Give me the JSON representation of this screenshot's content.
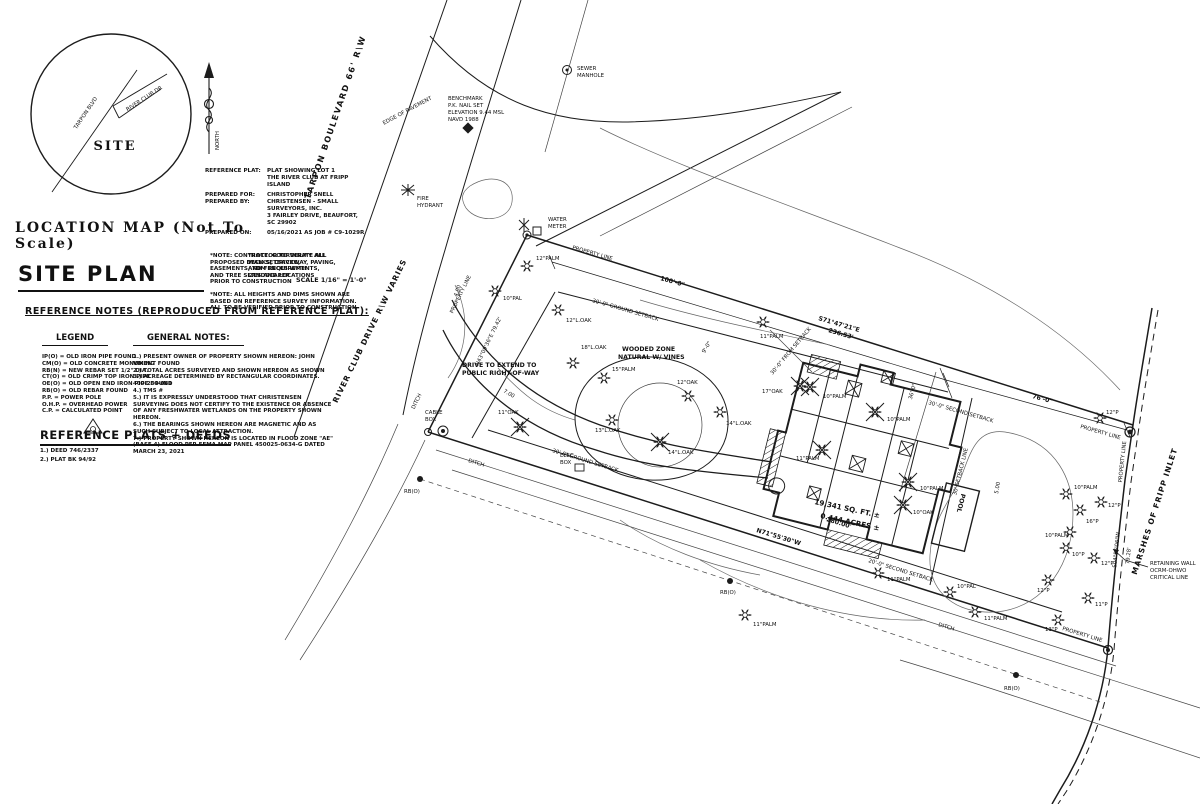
{
  "location_map": {
    "caption": "LOCATION MAP  (Not To Scale)",
    "road_tarpon": "TARPON BLVD",
    "road_river_club": "RIVER CLUB DR",
    "site": "SITE",
    "north": "NORTH"
  },
  "title_block": {
    "rows": [
      {
        "label": "REFERENCE PLAT:",
        "value": "PLAT SHOWING LOT 1"
      },
      {
        "label": "",
        "value": "THE RIVER CLUB AT FRIPP ISLAND"
      },
      {
        "label": "PREPARED FOR:",
        "value": "CHRISTOPHER SNELL"
      },
      {
        "label": "PREPARED BY:",
        "value": "CHRISTENSEN - SMALL SURVEYORS, INC."
      },
      {
        "label": "",
        "value": "3 FAIRLEY DRIVE, BEAUFORT, SC 29902"
      },
      {
        "label": "PREPARED ON:",
        "value": "05/16/2021 AS JOB # C9-1029R"
      }
    ]
  },
  "header": {
    "title": "SITE PLAN",
    "note_a": "*NOTE: CONTRACTOR TO VERIFY ALL PROPOSED DECK SETBACKS, EASEMENTS, TDM REQUIREMENTS, AND TREE SIZES AND LOCATIONS PRIOR TO CONSTRUCTION",
    "note_b": "*NOTE: COORDINATE ALL WALKS, DRIVEWAY, PAVING, AND FENCES WITH LANDSCAPER",
    "note_c": "*NOTE: ALL HEIGHTS AND DIMS SHOWN ARE BASED ON REFERENCE SURVEY INFORMATION. ALL TO BE VERIFIED PRIOR TO CONSTRUCTION",
    "scale": "SCALE 1/16\" = 1'-0\""
  },
  "reference_notes": {
    "heading": "REFERENCE NOTES (REPRODUCED FROM REFERENCE PLAT):",
    "legend_heading": "LEGEND",
    "legend_items": [
      "IP(O) = OLD IRON PIPE FOUND",
      "CM(O) = OLD CONCRETE MONUMENT FOUND",
      "RB(N) = NEW REBAR SET 1/2\" DIA.",
      "CT(O) = OLD CRIMP TOP IRON PIPE",
      "OE(O) = OLD OPEN END IRON PIPE FOUND",
      "RB(O) = OLD REBAR FOUND",
      "P.P.  = POWER POLE",
      "O.H.P. = OVERHEAD POWER",
      "C.P.  = CALCULATED POINT"
    ],
    "notes_heading": "GENERAL NOTES:",
    "notes_items": [
      "1.) PRESENT OWNER OF PROPERTY SHOWN HEREON: JOHN VIKING",
      "2.) TOTAL ACRES SURVEYED AND SHOWN HEREON AS SHOWN",
      "3.) ACREAGE DETERMINED BY RECTANGULAR COORDINATES.  400-234-081",
      "4.) TMS #",
      "5.) IT IS EXPRESSLY UNDERSTOOD THAT CHRISTENSEN SURVEYING DOES NOT CERTIFY TO THE EXISTENCE OR ABSENCE OF ANY FRESHWATER WETLANDS ON THE PROPERTY SHOWN HEREON.",
      "6.) THE BEARINGS SHOWN HEREON ARE MAGNETIC AND AS SUCH SUBJECT TO LOCAL ATTRACTION.",
      "7.) PROPERTY SHOWN HEREON IS LOCATED IN FLOOD ZONE \"AE\" (BASE 4) FLOOD PER FEMA MAP PANEL 450025-0634-G DATED  MARCH 23, 2021"
    ]
  },
  "plats_deeds": {
    "heading": "REFERENCE PLATS + DEEDS",
    "items": [
      "1.) DEED 746/2337",
      "2.) PLAT BK 94/92"
    ]
  },
  "plan": {
    "road_tarpon": "TARPON BOULEVARD  66' R\\W",
    "edge_of_pavement": "EDGE OF PAVEMENT",
    "road_river_club": "RIVER CLUB DRIVE  R\\W VARIES",
    "sewer1": "SEWER",
    "sewer2": "MANHOLE",
    "bm1": "BENCHMARK",
    "bm2": "P.K. NAIL SET",
    "bm3": "ELEVATION 9.44 MSL",
    "bm4": "NAVD 1988",
    "fh1": "FIRE",
    "fh2": "HYDRANT",
    "wm1": "WATER",
    "wm2": "METER",
    "property_line": "PROPERTY LINE",
    "dim100": "100'-0\"",
    "dim76": "76'-0\"",
    "dim36": "36'-0\"",
    "dim9": "9'-0\"",
    "brg_n1": "S71°47'21\"E",
    "brg_n2": "236.53'",
    "brg_w": "N43°09'36\"E  79.42'",
    "brg_s1": "280.00'",
    "brg_s2": "N71°55'30\"W",
    "brg_e1": "S04°56'06\"W",
    "brg_e2": "79.28'",
    "ground_setback": "30'-0\" GROUND SETBACK",
    "second_setback": "30'-0\" SECOND SETBACK",
    "from_setback": "30'-0\" FROM SETBACK",
    "setback_line": "30' SETBACK LINE",
    "second_setback_s": "20'-0\" SECOND SETBACK",
    "drive1": "DRIVE TO EXTEND TO",
    "drive2": "PUBLIC RIGHT-OF-WAY",
    "wood1": "WOODED ZONE",
    "wood2": "NATURAL W/ VINES",
    "cable1": "CABLE",
    "cable2": "BOX",
    "elec1": "ELEC",
    "elec2": "BOX",
    "ditch": "DITCH",
    "rbo": "RB(O)",
    "area1": "19,341 SQ. FT. ±",
    "area2": "0.444 ACRES ±",
    "pool": "POOL",
    "marshes": "MARSHES OF FRIPP INLET",
    "ret1": "RETAINING WALL",
    "ret2": "OCRM-OHWO",
    "ret3": "CRITICAL LINE",
    "c4": "4.00",
    "c5": "5.00",
    "c7": "7.00",
    "tree_labels": [
      "12\"PALM",
      "10\"PAL",
      "12\"L.OAK",
      "18\"L.OAK",
      "15\"PALM",
      "12\"OAK",
      "17\"OAK",
      "14\"L.OAK",
      "14\"L.OAK",
      "13\"L.OAK",
      "11\"OAK",
      "11\"PALM",
      "10\"PALM",
      "10\"PALM",
      "11\"PALM",
      "10\"PALM",
      "10\"OAK",
      "11\"PALM",
      "11\"PALM",
      "10\"PAL",
      "11\"PALM",
      "10\"PALM",
      "16\"P",
      "12\"P",
      "10\"PALM",
      "10\"P",
      "12\"P",
      "12\"P",
      "11\"P",
      "12\"P",
      "13\"P"
    ]
  },
  "colors": {
    "ink": "#1c1c1c",
    "paper": "#ffffff"
  }
}
